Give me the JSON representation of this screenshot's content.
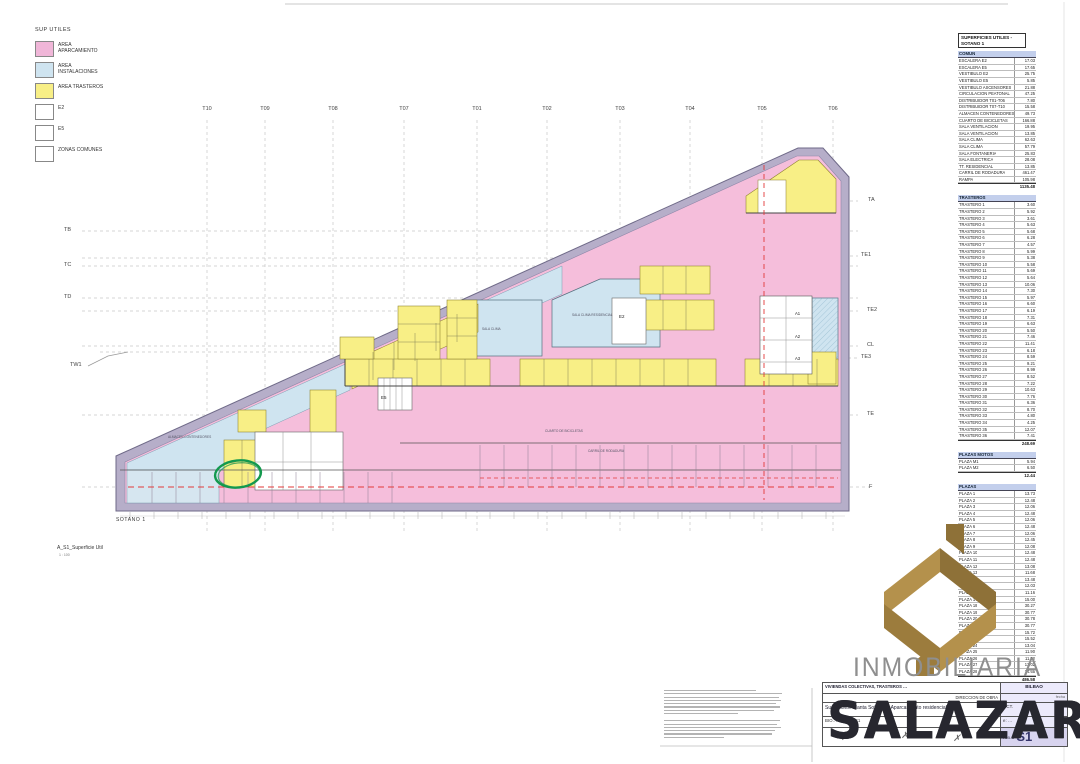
{
  "legend": {
    "title": "SUP UTILES",
    "items": [
      {
        "label": "AREA APARCAMIENTO",
        "color": "#f0b6d8"
      },
      {
        "label": "AREA INSTALACIONES",
        "color": "#cfe4f0"
      },
      {
        "label": "AREA TRASTEROS",
        "color": "#f8ef86"
      },
      {
        "label": "E2",
        "color": "#ffffff"
      },
      {
        "label": "E5",
        "color": "#ffffff"
      },
      {
        "label": "ZONAS COMUNES",
        "color": "#ffffff"
      }
    ]
  },
  "grid": {
    "top": [
      "T10",
      "T09",
      "T08",
      "T07",
      "T01",
      "T02",
      "T03",
      "T04",
      "T05",
      "T06"
    ],
    "left": [
      "TB",
      "TC",
      "TD",
      "TW1"
    ],
    "right": [
      "TA",
      "TE1",
      "TE2",
      "CL",
      "TE3",
      "TE",
      "F"
    ]
  },
  "plan": {
    "floor_label": "SOTANO 1",
    "drawing_name": "A_S1_Superficie Util",
    "drawing_scale": "1 : 100",
    "labels": {
      "e2": "E2",
      "e5": "E5",
      "a1": "A1",
      "a2": "A2",
      "a3": "A3"
    },
    "rooms": {
      "almacen": "ALMACEN CONTENEDORES",
      "sala_clima": "SALA CLIMA",
      "sala_clima_res": "SALA CLIMA RESIDENCIAL",
      "bicicletas": "CUARTO DE BICICLETAS",
      "carril": "CARRIL DE RODADURA"
    }
  },
  "table": {
    "title": "SUPERFICIES UTILES -SOTANO 1",
    "sections": [
      {
        "name": "COMUN",
        "rows": [
          [
            "ESCALERA E2",
            "17.03"
          ],
          [
            "ESCALERA E5",
            "17.65"
          ],
          [
            "VESTIBULO E2",
            "25.75"
          ],
          [
            "VESTIBULO E5",
            "5.85"
          ],
          [
            "VESTIBULO ASCENSORES",
            "21.88"
          ],
          [
            "CIRCULACION PEATONAL",
            "47.25"
          ],
          [
            "DISTRIBUIDOR T01-T06",
            "7.80"
          ],
          [
            "DISTRIBUIDOR T07-T10",
            "15.58"
          ],
          [
            "ALMACEN CONTENEDORES",
            "49.73"
          ],
          [
            "CUARTO DE BICICLETAS",
            "166.88"
          ],
          [
            "SALA VENTILACION",
            "19.95"
          ],
          [
            "SALA VENTILACION",
            "13.85"
          ],
          [
            "SALA CLIMA",
            "62.63"
          ],
          [
            "SALA CLIMA",
            "57.79"
          ],
          [
            "SALA FONTANERIA",
            "25.83"
          ],
          [
            "SALA ELECTRICA",
            "28.08"
          ],
          [
            "TT. RESIDENCIAL",
            "13.85"
          ],
          [
            "CARRIL DE RODADURA",
            "461.47"
          ],
          [
            "RAMPA",
            "105.98"
          ]
        ],
        "total": "1135.48"
      },
      {
        "name": "TRASTEROS",
        "rows": [
          [
            "TRASTERO 1",
            "3.60"
          ],
          [
            "TRASTERO 2",
            "5.92"
          ],
          [
            "TRASTERO 3",
            "3.61"
          ],
          [
            "TRASTERO 4",
            "5.63"
          ],
          [
            "TRASTERO 5",
            "5.68"
          ],
          [
            "TRASTERO 6",
            "6.28"
          ],
          [
            "TRASTERO 7",
            "4.57"
          ],
          [
            "TRASTERO 8",
            "5.99"
          ],
          [
            "TRASTERO 9",
            "5.38"
          ],
          [
            "TRASTERO 10",
            "5.58"
          ],
          [
            "TRASTERO 11",
            "5.69"
          ],
          [
            "TRASTERO 12",
            "5.64"
          ],
          [
            "TRASTERO 13",
            "10.06"
          ],
          [
            "TRASTERO 14",
            "7.30"
          ],
          [
            "TRASTERO 15",
            "5.97"
          ],
          [
            "TRASTERO 16",
            "6.60"
          ],
          [
            "TRASTERO 17",
            "6.19"
          ],
          [
            "TRASTERO 18",
            "7.31"
          ],
          [
            "TRASTERO 19",
            "6.63"
          ],
          [
            "TRASTERO 20",
            "5.50"
          ],
          [
            "TRASTERO 21",
            "7.46"
          ],
          [
            "TRASTERO 22",
            "11.41"
          ],
          [
            "TRASTERO 23",
            "6.18"
          ],
          [
            "TRASTERO 24",
            "8.59"
          ],
          [
            "TRASTERO 25",
            "9.21"
          ],
          [
            "TRASTERO 26",
            "8.99"
          ],
          [
            "TRASTERO 27",
            "8.52"
          ],
          [
            "TRASTERO 28",
            "7.22"
          ],
          [
            "TRASTERO 29",
            "10.63"
          ],
          [
            "TRASTERO 30",
            "7.76"
          ],
          [
            "TRASTERO 31",
            "6.36"
          ],
          [
            "TRASTERO 32",
            "8.70"
          ],
          [
            "TRASTERO 33",
            "4.80"
          ],
          [
            "TRASTERO 34",
            "4.25"
          ],
          [
            "TRASTERO 35",
            "12.07"
          ],
          [
            "TRASTERO 36",
            "7.41"
          ]
        ],
        "total": "248.69"
      },
      {
        "name": "PLAZAS MOTOS",
        "rows": [
          [
            "PLAZA M1",
            "5.94"
          ],
          [
            "PLAZA M2",
            "6.50"
          ]
        ],
        "total": "12.44"
      },
      {
        "name": "PLAZAS",
        "rows": [
          [
            "PLAZA 1",
            "13.73"
          ],
          [
            "PLAZA 2",
            "12.48"
          ],
          [
            "PLAZA 3",
            "12.06"
          ],
          [
            "PLAZA 4",
            "12.48"
          ],
          [
            "PLAZA 5",
            "12.06"
          ],
          [
            "PLAZA 6",
            "12.48"
          ],
          [
            "PLAZA 7",
            "12.06"
          ],
          [
            "PLAZA 8",
            "12.45"
          ],
          [
            "PLAZA 9",
            "12.08"
          ],
          [
            "PLAZA 10",
            "12.48"
          ],
          [
            "PLAZA 11",
            "12.48"
          ],
          [
            "PLAZA 12",
            "13.08"
          ],
          [
            "PLAZA 13",
            "11.68"
          ],
          [
            "PLAZA 14",
            "13.48"
          ],
          [
            "PLAZA 15",
            "12.03"
          ],
          [
            "PLAZA 16",
            "11.16"
          ],
          [
            "PLAZA 17",
            "15.00"
          ],
          [
            "PLAZA 18",
            "30.27"
          ],
          [
            "PLAZA 19",
            "30.77"
          ],
          [
            "PLAZA 20",
            "30.78"
          ],
          [
            "PLAZA 21",
            "30.77"
          ],
          [
            "PLAZA 22",
            "15.72"
          ],
          [
            "PLAZA 23",
            "15.52"
          ],
          [
            "PLAZA 24",
            "13.04"
          ],
          [
            "PLAZA 25",
            "11.90"
          ],
          [
            "PLAZA 26",
            "11.52"
          ],
          [
            "PLAZA 27",
            "13.02"
          ],
          [
            "PLAZA 28",
            "14.65"
          ]
        ],
        "total": "486.58"
      }
    ]
  },
  "title_block": {
    "project": "VIVIENDAS COLECTIVAS, TRASTEROS …",
    "city": "BILBAO",
    "direccion": "DIRECCION DE OBRA",
    "fecha_label": "fecha",
    "sheet_title": "Superficies. Planta Sotano 1. Aparcamiento residencial",
    "code": "BIO…-DR-A…-S1",
    "date": "OCT.",
    "scale": "e: …",
    "sheet_code": "A05-U",
    "sheet_num": "S1"
  },
  "watermark": {
    "brand_top": "INMOBILIARIA",
    "brand_bottom": "SALAZAR"
  }
}
